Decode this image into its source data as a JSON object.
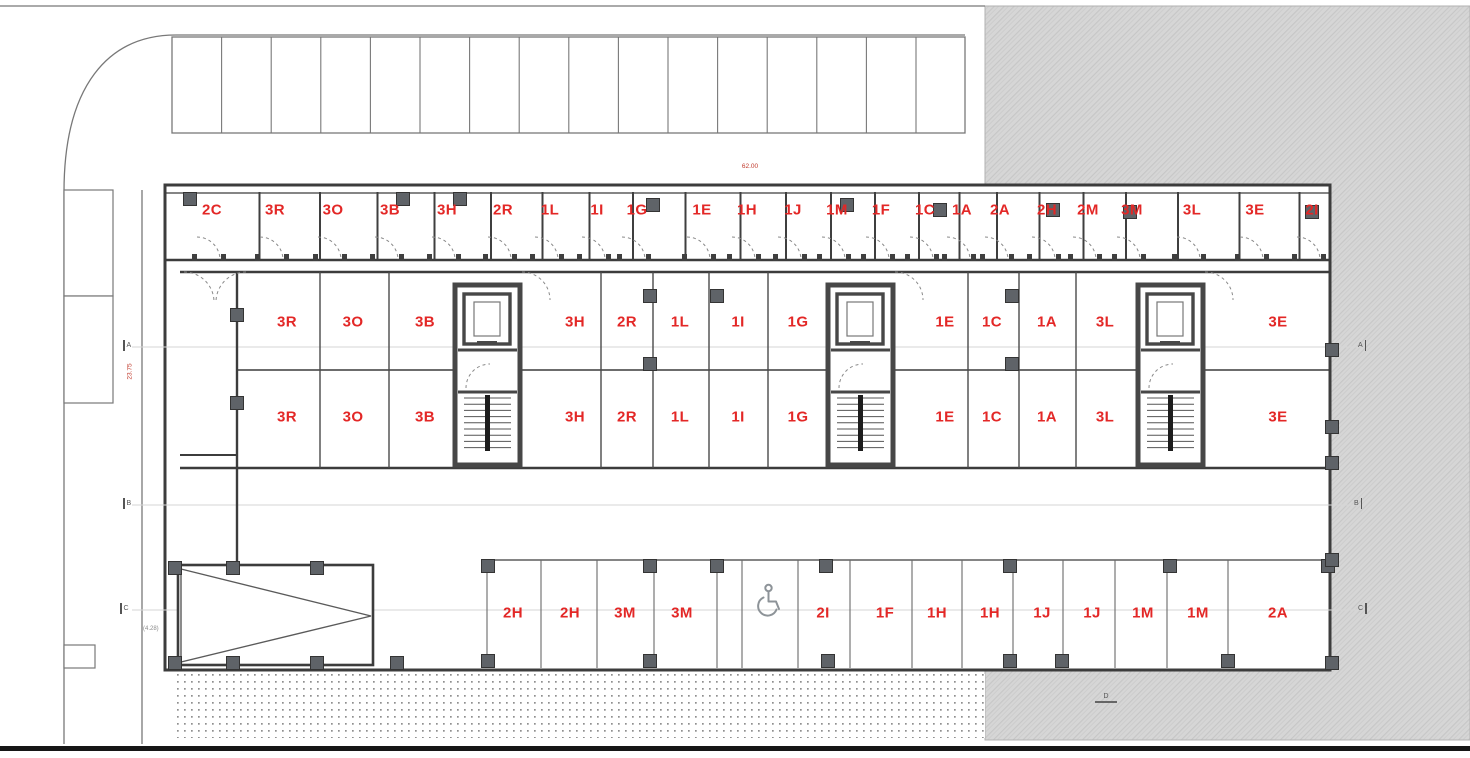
{
  "plan": {
    "type": "architectural-floor-plan",
    "accent_red": "#e32726",
    "wall_color": "#3c3c3c",
    "dimensions": {
      "top": "62.00",
      "left_vertical": "23.75",
      "left_small": "(4.28)"
    },
    "section_marker": "D",
    "grid_markers": {
      "left": [
        {
          "label": "A"
        },
        {
          "label": "B"
        },
        {
          "label": "C"
        }
      ],
      "right": [
        {
          "label": "A"
        },
        {
          "label": "B"
        },
        {
          "label": "C"
        }
      ]
    },
    "unit_rows": {
      "storage_top": {
        "y": 210,
        "units": [
          {
            "label": "2C",
            "x": 212
          },
          {
            "label": "3R",
            "x": 275
          },
          {
            "label": "3O",
            "x": 333
          },
          {
            "label": "3B",
            "x": 390
          },
          {
            "label": "3H",
            "x": 447
          },
          {
            "label": "2R",
            "x": 503
          },
          {
            "label": "1L",
            "x": 550
          },
          {
            "label": "1I",
            "x": 597
          },
          {
            "label": "1G",
            "x": 637
          },
          {
            "label": "1E",
            "x": 702
          },
          {
            "label": "1H",
            "x": 747
          },
          {
            "label": "1J",
            "x": 793
          },
          {
            "label": "1M",
            "x": 837
          },
          {
            "label": "1F",
            "x": 881
          },
          {
            "label": "1C",
            "x": 925
          },
          {
            "label": "1A",
            "x": 962
          },
          {
            "label": "2A",
            "x": 1000
          },
          {
            "label": "2H",
            "x": 1047
          },
          {
            "label": "2M",
            "x": 1088
          },
          {
            "label": "3M",
            "x": 1132
          },
          {
            "label": "3L",
            "x": 1192
          },
          {
            "label": "3E",
            "x": 1255
          },
          {
            "label": "2I",
            "x": 1312
          }
        ]
      },
      "mid_upper": {
        "y": 322,
        "units": [
          {
            "label": "3R",
            "x": 287
          },
          {
            "label": "3O",
            "x": 353
          },
          {
            "label": "3B",
            "x": 425
          },
          {
            "label": "3H",
            "x": 575
          },
          {
            "label": "2R",
            "x": 627
          },
          {
            "label": "1L",
            "x": 680
          },
          {
            "label": "1I",
            "x": 738
          },
          {
            "label": "1G",
            "x": 798
          },
          {
            "label": "1E",
            "x": 945
          },
          {
            "label": "1C",
            "x": 992
          },
          {
            "label": "1A",
            "x": 1047
          },
          {
            "label": "3L",
            "x": 1105
          },
          {
            "label": "3E",
            "x": 1278
          }
        ]
      },
      "mid_lower": {
        "y": 417,
        "units": [
          {
            "label": "3R",
            "x": 287
          },
          {
            "label": "3O",
            "x": 353
          },
          {
            "label": "3B",
            "x": 425
          },
          {
            "label": "3H",
            "x": 575
          },
          {
            "label": "2R",
            "x": 627
          },
          {
            "label": "1L",
            "x": 680
          },
          {
            "label": "1I",
            "x": 738
          },
          {
            "label": "1G",
            "x": 798
          },
          {
            "label": "1E",
            "x": 945
          },
          {
            "label": "1C",
            "x": 992
          },
          {
            "label": "1A",
            "x": 1047
          },
          {
            "label": "3L",
            "x": 1105
          },
          {
            "label": "3E",
            "x": 1278
          }
        ]
      },
      "parking_bottom": {
        "y": 613,
        "stalls": [
          {
            "label": "2H",
            "x": 513
          },
          {
            "label": "2H",
            "x": 570
          },
          {
            "label": "3M",
            "x": 625
          },
          {
            "label": "3M",
            "x": 682
          },
          {
            "label": "",
            "x": 768,
            "accessible": true,
            "icon": "wheelchair-icon"
          },
          {
            "label": "2I",
            "x": 823
          },
          {
            "label": "1F",
            "x": 885
          },
          {
            "label": "1H",
            "x": 937
          },
          {
            "label": "1H",
            "x": 990
          },
          {
            "label": "1J",
            "x": 1042
          },
          {
            "label": "1J",
            "x": 1092
          },
          {
            "label": "1M",
            "x": 1143
          },
          {
            "label": "1M",
            "x": 1198
          },
          {
            "label": "2A",
            "x": 1278
          }
        ]
      }
    }
  }
}
